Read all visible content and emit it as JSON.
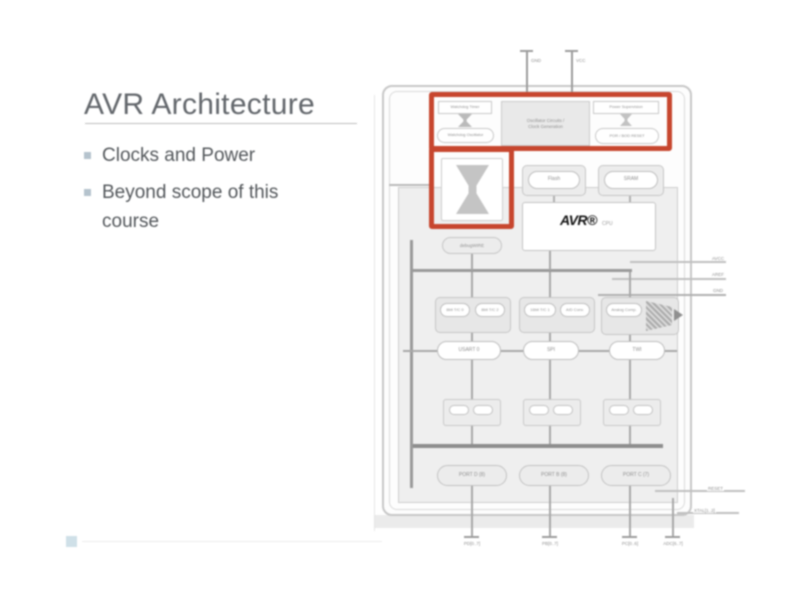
{
  "slide": {
    "title": "AVR Architecture",
    "bullets": [
      "Clocks and Power",
      "Beyond scope of this course"
    ]
  },
  "diagram": {
    "pins_top": {
      "gnd": "GND",
      "vcc": "VCC"
    },
    "clock_row": {
      "watchdog_timer": "Watchdog Timer",
      "watchdog_oscillator": "Watchdog Oscillator",
      "oscillator_circuits": "Oscillator Circuits /",
      "clock_generation": "Clock Generation",
      "power_supervision": "Power Supervision",
      "por_bod_reset": "POR / BOD RESET"
    },
    "debugwire": "debugWIRE",
    "memory": {
      "flash": "Flash",
      "sram": "SRAM"
    },
    "cpu": {
      "logo": "AVR®",
      "label": "CPU"
    },
    "right_pins": [
      "AVCC",
      "AREF",
      "GND"
    ],
    "peripherals": {
      "tc0": "8bit T/C 0",
      "tc2": "8bit T/C 2",
      "tc1": "16bit T/C 1",
      "adc": "A/D Conv.",
      "analog_comp": "Analog Comp.",
      "usart": "USART 0",
      "spi": "SPI",
      "twi": "TWI"
    },
    "ports": {
      "portd": "PORT D (8)",
      "portb": "PORT B (8)",
      "portc": "PORT C (7)"
    },
    "bottom_pins": [
      "PD[0..7]",
      "PB[0..7]",
      "PC[0..6]",
      "ADC[6..7]"
    ],
    "side_pins": {
      "reset": "RESET",
      "xtal": "XTAL[1..2]"
    },
    "highlight_color": "#c7462e"
  }
}
